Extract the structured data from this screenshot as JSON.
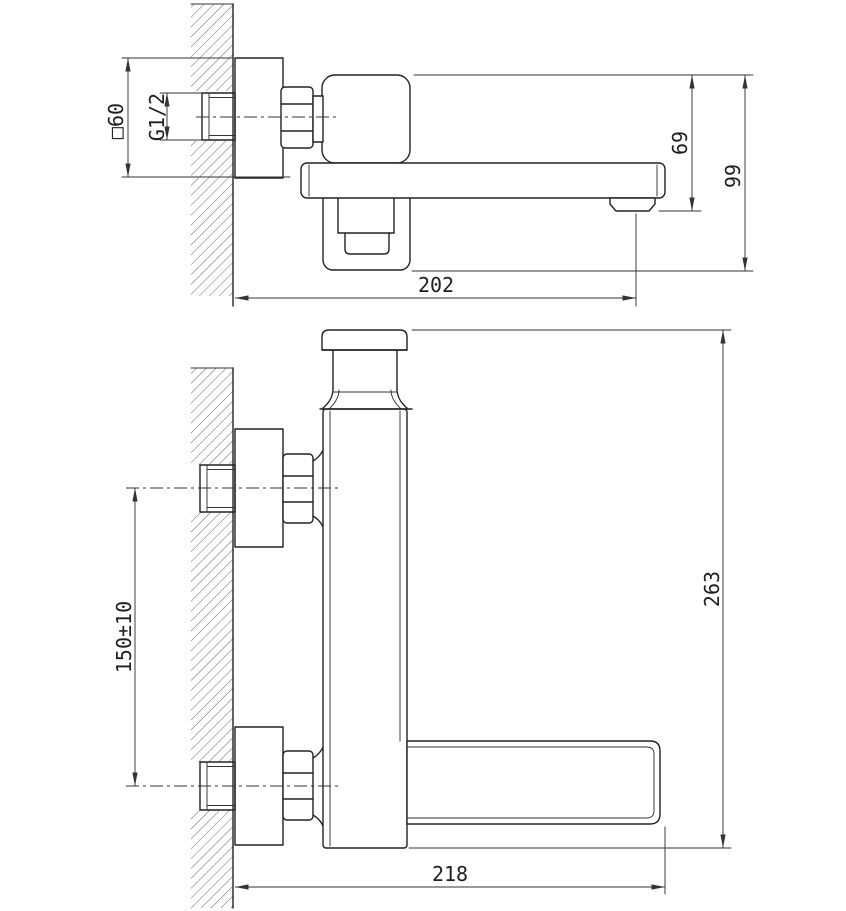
{
  "colors": {
    "line": "#222222",
    "dim_line": "#333333",
    "background": "#ffffff"
  },
  "top_view": {
    "dims": {
      "escutcheon": "□60",
      "thread": "G1/2",
      "drop_to_outlet": "69",
      "overall_depth": "99",
      "spout_reach": "202"
    }
  },
  "front_view": {
    "dims": {
      "inlet_spacing": "150±10",
      "overall_height": "263",
      "overall_reach": "218"
    }
  }
}
